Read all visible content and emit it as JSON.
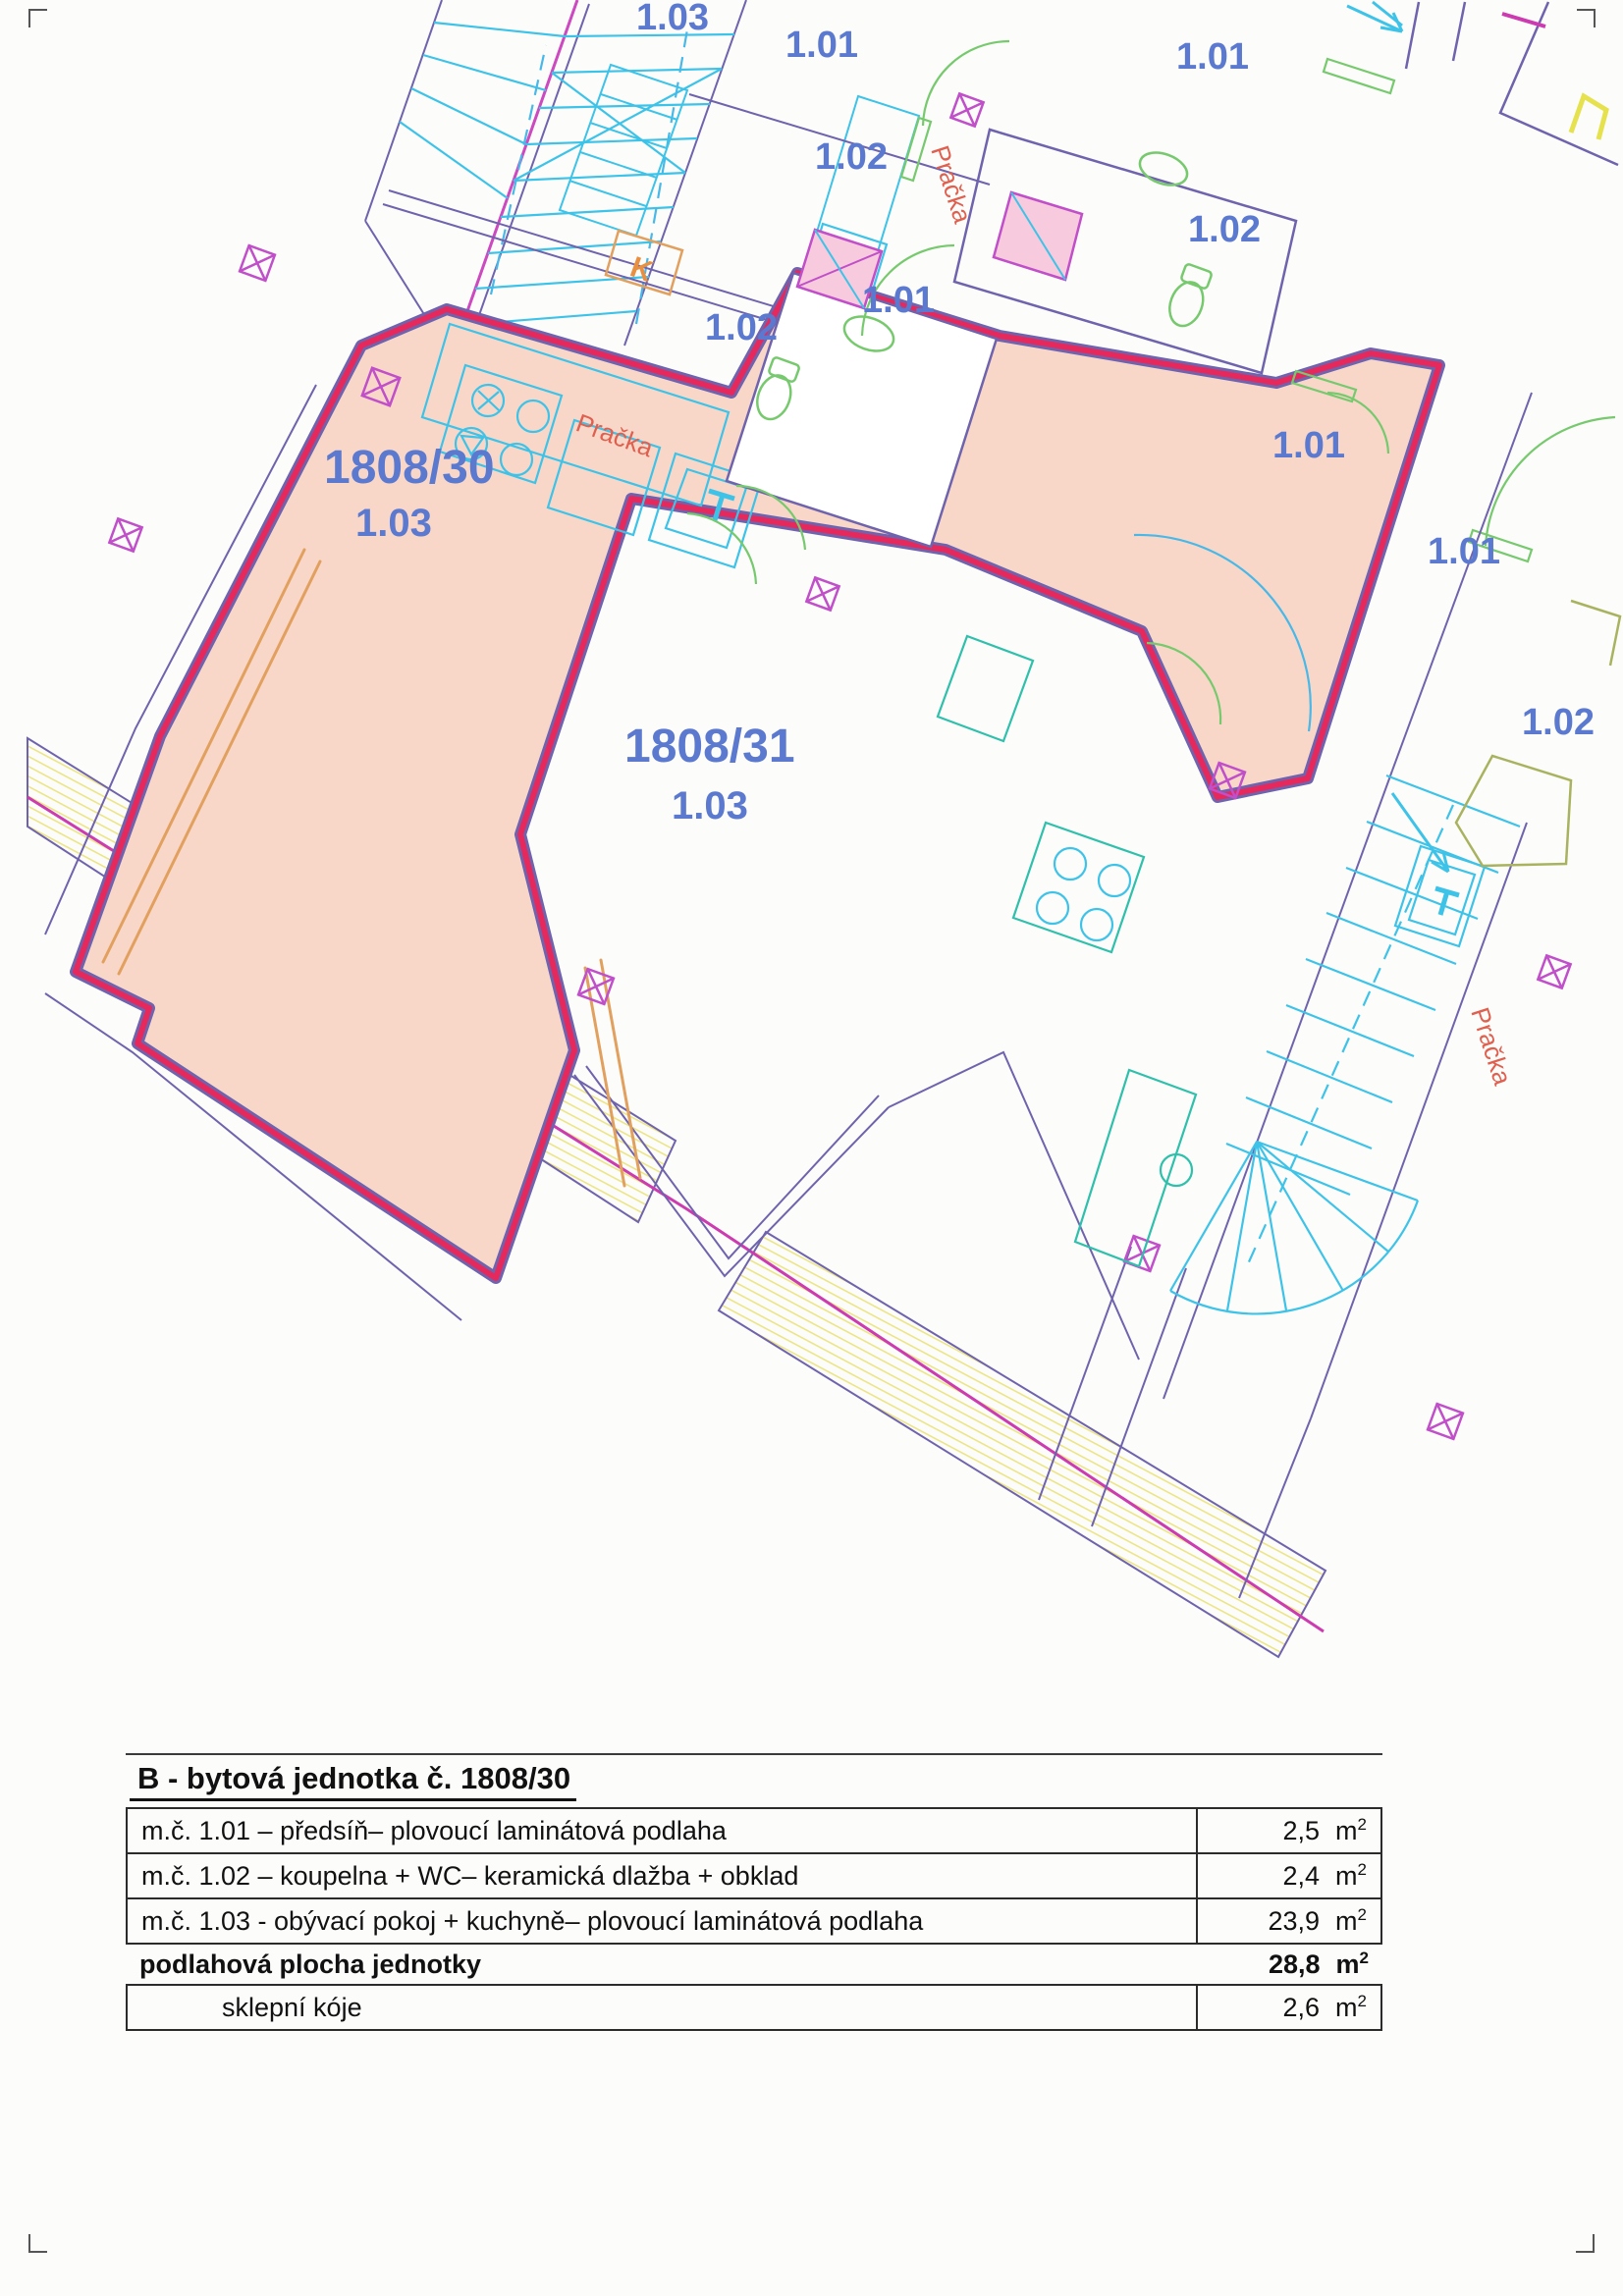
{
  "plan": {
    "room_labels": [
      {
        "text": "1.03"
      },
      {
        "text": "1.01"
      },
      {
        "text": "1.02"
      },
      {
        "text": "1.01"
      },
      {
        "text": "1.02"
      },
      {
        "text": "1.01"
      },
      {
        "text": "1.02"
      },
      {
        "text": "1.01"
      },
      {
        "text": "1.01"
      },
      {
        "text": "1.02"
      },
      {
        "text": "1808/30"
      },
      {
        "text": "1.03"
      },
      {
        "text": "1808/31"
      },
      {
        "text": "1.03"
      }
    ],
    "appliance_labels": [
      {
        "text": "Pračka"
      },
      {
        "text": "Pračka"
      },
      {
        "text": "Pračka"
      }
    ],
    "misc_labels": [
      {
        "text": "K"
      }
    ],
    "colors": {
      "unit_highlight_fill": "#f8d7c9",
      "unit_boundary_red": "#e6295c",
      "wall_purple": "#6f63ad",
      "column_magenta": "#c04fc9",
      "fixture_cyan": "#3ec3e8",
      "fixture_teal": "#2fc0ab",
      "door_green": "#77c96e",
      "door_olive": "#a9b35f",
      "feature_orange": "#e2a05e",
      "terrace_hatch_yellow": "#ece585",
      "label_blue": "#5b79cf",
      "label_red": "#e0604f",
      "site_line_magenta": "#cc3bb0"
    }
  },
  "table": {
    "title": "B - bytová jednotka č. 1808/30",
    "unit": {
      "base": "m",
      "exp": "2"
    },
    "rows": [
      {
        "label": "m.č. 1.01 – předsíň– plovoucí laminátová podlaha",
        "value": "2,5"
      },
      {
        "label": "m.č. 1.02 – koupelna + WC– keramická dlažba + obklad",
        "value": "2,4"
      },
      {
        "label": "m.č. 1.03 - obývací pokoj + kuchyně– plovoucí laminátová podlaha",
        "value": "23,9"
      },
      {
        "label": "podlahová plocha jednotky",
        "value": "28,8"
      },
      {
        "label": "sklepní kóje",
        "value": "2,6"
      }
    ]
  }
}
